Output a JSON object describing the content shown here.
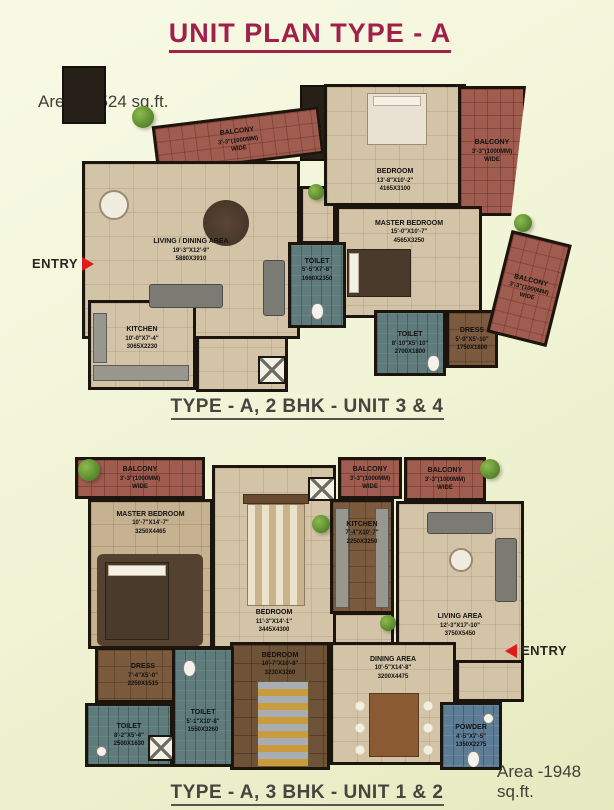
{
  "title": "UNIT PLAN TYPE - A",
  "colors": {
    "accent": "#a1204a",
    "entry_arrow": "#e21a1a",
    "caption_text": "#45453f"
  },
  "plans": [
    {
      "area_label": "Area - 1524 sq.ft.",
      "caption": "TYPE - A,  2 BHK - UNIT 3 & 4",
      "entry_label": "ENTRY",
      "rooms": [
        {
          "name": "BALCONY",
          "dim1": "3'-3\"(1000MM)",
          "dim2": "WIDE"
        },
        {
          "name": "BEDROOM",
          "dim1": "13'-8\"X10'-2\"",
          "dim2": "4165X3100"
        },
        {
          "name": "BALCONY",
          "dim1": "3'-3\"(1000MM)",
          "dim2": "WIDE"
        },
        {
          "name": "LIVING / DINING AREA",
          "dim1": "19'-3\"X12'-9\"",
          "dim2": "5880X3910"
        },
        {
          "name": "MASTER BEDROOM",
          "dim1": "15'-0\"X10'-7\"",
          "dim2": "4565X3250"
        },
        {
          "name": "TOILET",
          "dim1": "5'-5\"X7'-8\"",
          "dim2": "1660X2350"
        },
        {
          "name": "KITCHEN",
          "dim1": "10'-0\"X7'-4\"",
          "dim2": "3065X2230"
        },
        {
          "name": "TOILET",
          "dim1": "8'-10\"X5'-10\"",
          "dim2": "2700X1800"
        },
        {
          "name": "DRESS",
          "dim1": "5'-9\"X5'-10\"",
          "dim2": "1750X1800"
        },
        {
          "name": "BALCONY",
          "dim1": "3'-3\"(1000MM)",
          "dim2": "WIDE"
        }
      ]
    },
    {
      "area_label": "Area -1948 sq.ft.",
      "caption": "TYPE - A,  3 BHK - UNIT 1 & 2",
      "entry_label": "ENTRY",
      "rooms": [
        {
          "name": "BALCONY",
          "dim1": "3'-3\"(1000MM)",
          "dim2": "WIDE"
        },
        {
          "name": "MASTER BEDROOM",
          "dim1": "10'-7\"X14'-7\"",
          "dim2": "3250X4465"
        },
        {
          "name": "BEDROOM",
          "dim1": "11'-3\"X14'-1\"",
          "dim2": "3445X4300"
        },
        {
          "name": "BALCONY",
          "dim1": "3'-3\"(1000MM)",
          "dim2": "WIDE"
        },
        {
          "name": "KITCHEN",
          "dim1": "7'-4\"X10'-7\"",
          "dim2": "2250X3250"
        },
        {
          "name": "BALCONY",
          "dim1": "3'-3\"(1000MM)",
          "dim2": "WIDE"
        },
        {
          "name": "LIVING AREA",
          "dim1": "12'-3\"X17'-10\"",
          "dim2": "3750X5450"
        },
        {
          "name": "DINING AREA",
          "dim1": "10'-5\"X14'-8\"",
          "dim2": "3200X4475"
        },
        {
          "name": "BEDROOM",
          "dim1": "10'-7\"X10'-8\"",
          "dim2": "3230X3260"
        },
        {
          "name": "DRESS",
          "dim1": "7'-4\"X5'-0\"",
          "dim2": "2250X1515"
        },
        {
          "name": "TOILET",
          "dim1": "8'-2\"X5'-4\"",
          "dim2": "2500X1630"
        },
        {
          "name": "TOILET",
          "dim1": "5'-1\"X10'-8\"",
          "dim2": "1550X3260"
        },
        {
          "name": "POWDER",
          "dim1": "4'-5\"X7'-5\"",
          "dim2": "1350X2275"
        }
      ]
    }
  ]
}
